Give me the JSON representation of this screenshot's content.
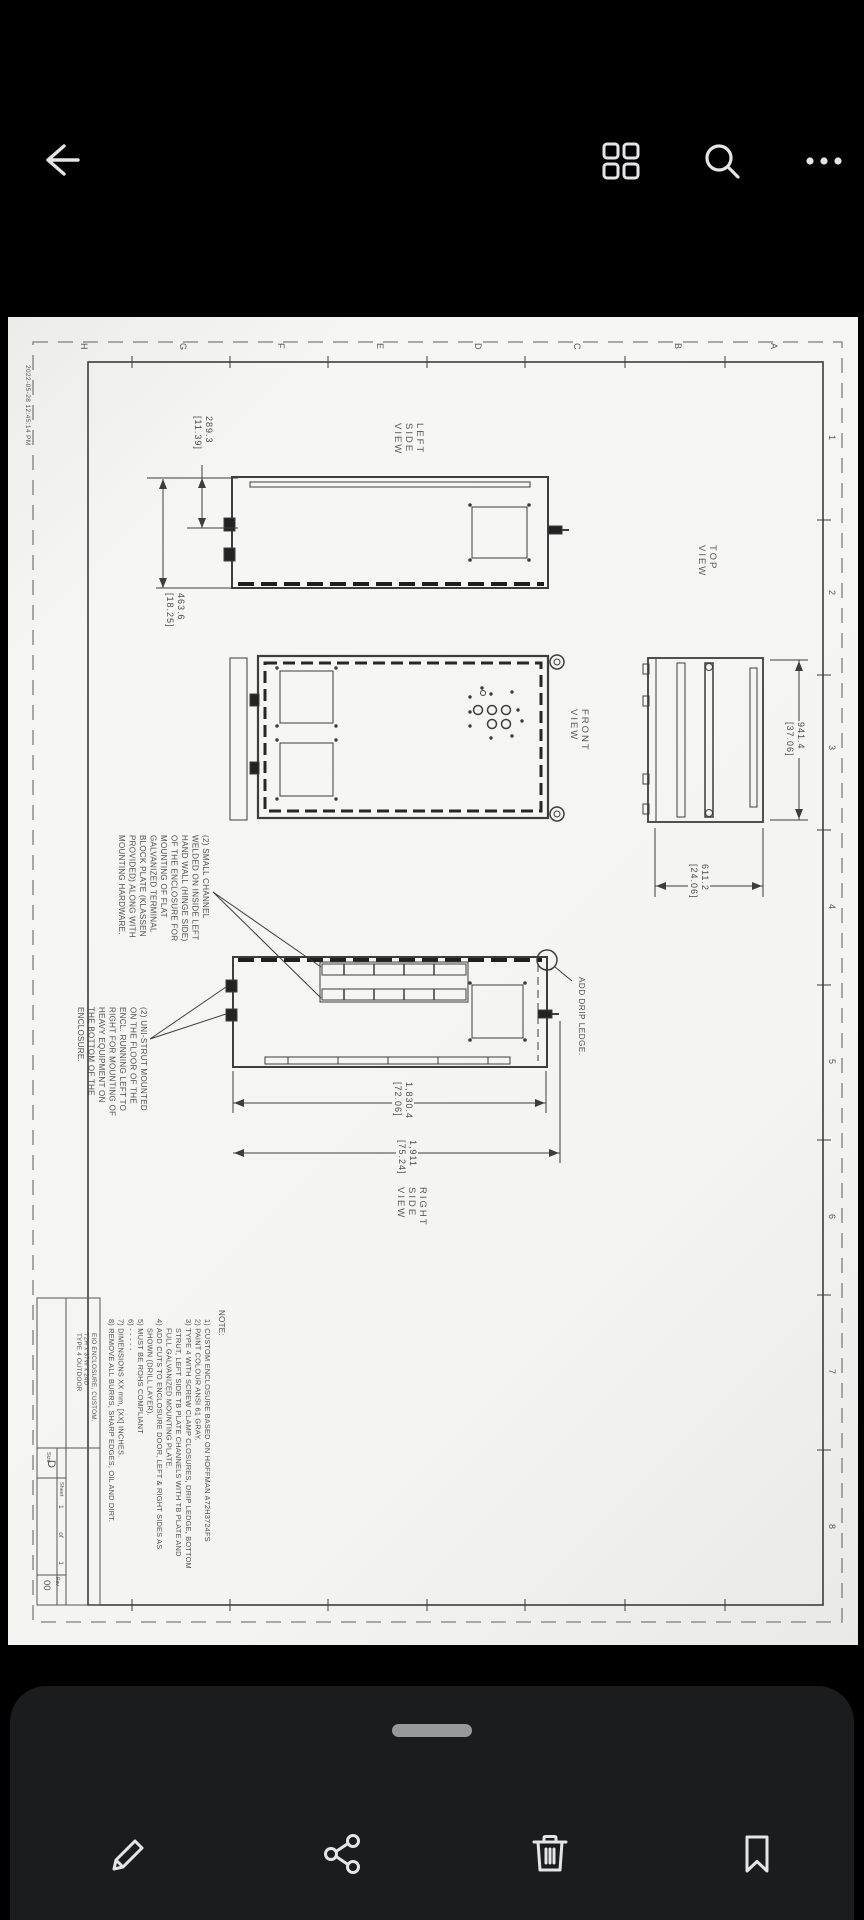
{
  "colors": {
    "page_background": "#000000",
    "sheet_paper": "#f4f4f2",
    "toolbar_panel": "#1b1c1e",
    "icon_light": "#e4e5e7",
    "drawing_line": "#3d3d3d",
    "drawing_text": "#4a4a4a"
  },
  "top_bar": {
    "icon_names": [
      "back-arrow",
      "grid-view",
      "search",
      "more-options"
    ]
  },
  "sheet": {
    "date_stamp": "2022-05-28 12:45:14 PM",
    "zone_letters": [
      "H",
      "G",
      "F",
      "E",
      "D",
      "C",
      "B",
      "A"
    ],
    "zone_numbers": [
      "1",
      "2",
      "3",
      "4",
      "5",
      "6",
      "7",
      "8"
    ],
    "views": {
      "left_side": {
        "label": "LEFT\nSIDE\nVIEW",
        "dim_top": "289.3\n[11.39]",
        "dim_full": "463.6\n[18.25]"
      },
      "front": {
        "label": "FRONT\nVIEW"
      },
      "top": {
        "label": "TOP\nVIEW",
        "dim_depth": "941.4\n[37.06]",
        "dim_width": "611.2\n[24.06]"
      },
      "right_side": {
        "label": "RIGHT\nSIDE\nVIEW",
        "dim_body": "1,830.4\n[72.06]",
        "dim_overall": "1,911\n[75.24]",
        "drip_callout": "ADD DRIP LEDGE."
      }
    },
    "callouts": {
      "channel_note": "(2) SMALL CHANNEL\nWELDED ON INSIDE LEFT\nHAND WALL (HINGE SIDE)\nOF THE ENCLOSURE FOR\nMOUNTING OF FLAT\nGALVANIZED TERMINAL\nBLOCK PLATE (KLASSEN\nPROVIDED) ALONG WITH\nMOUNTING HARDWARE.",
      "unistrut_note": "(2) UNI-STRUT MOUNTED\nON THE FLOOR OF THE\nENCL. RUNNING LEFT TO\nRIGHT FOR MOUNTING OF\nHEAVY EQUIPMENT ON\nTHE BOTTOM OF THE\nENCLOSURE."
    },
    "notes": {
      "header": "NOTE:",
      "body": "1) CUSTOM ENCLOSURE BASED ON HOFFMAN A72H3724FS\n2) PAINT COLOUR ANSI 61 GRAY.\n3) TYPE 4 WITH SCREW CLAMP CLOSURES, DRIP LEDGE, BOTTOM\n    STRUT, LEFT SIDE TB PLATE CHANNELS WITH TB PLATE AND\n    FULL GALVANIZED MOUNTING PLATE.\n4) ADD CUTS TO ENCLOSURE DOOR, LEFT & RIGHT SIDES AS\n    SHOWN (DRILL LAYER).\n5) MUST BE ROHS COMPLIANT\n6) - - - - -\n7) DIMENSIONS XX mm, [XX] INCHES.\n8) REMOVE ALL BURRS, SHARP EDGES, OIL AND DIRT."
    },
    "title_block": {
      "title": "EIO ENCLOSURE, CUSTOM,\n72H x 37W x 24D\nTYPE 4 OUTDOOR",
      "size_label": "Size",
      "size": "D",
      "sheet_label": "Sheet",
      "sheet_info": "1  of  1",
      "rev_label": "Rev",
      "rev": "00"
    }
  },
  "toolbar": {
    "icon_names": [
      "edit-pencil",
      "share",
      "delete-trash",
      "bookmark"
    ],
    "handle_name": "drag-handle"
  }
}
